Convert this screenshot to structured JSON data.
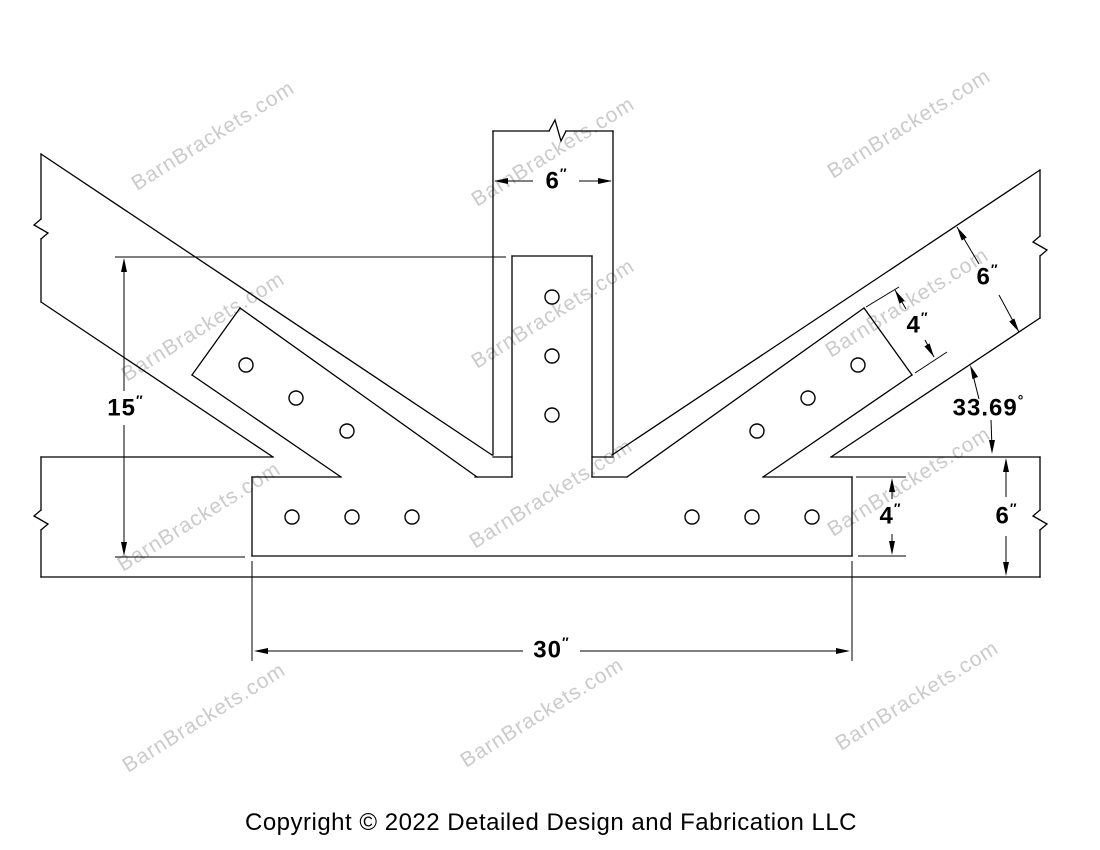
{
  "watermark": {
    "text": "BarnBrackets.com",
    "color": "#cbcbcb",
    "angle": -32,
    "positions": [
      [
        137,
        191
      ],
      [
        477,
        207
      ],
      [
        833,
        179
      ],
      [
        127,
        382
      ],
      [
        477,
        369
      ],
      [
        831,
        358
      ],
      [
        123,
        572
      ],
      [
        475,
        549
      ],
      [
        833,
        537
      ],
      [
        128,
        773
      ],
      [
        466,
        768
      ],
      [
        841,
        751
      ]
    ]
  },
  "copyright": {
    "text": "Copyright © 2022 Detailed Design and Fabrication LLC"
  },
  "drawing": {
    "line_color": "#000000",
    "timber_lines": [
      [
        493,
        131,
        549,
        131
      ],
      [
        566,
        131,
        613,
        131
      ],
      [
        493,
        131,
        493,
        455
      ],
      [
        613,
        131,
        613,
        455
      ],
      [
        41,
        457,
        273,
        457
      ],
      [
        493,
        457,
        512,
        457
      ],
      [
        592,
        457,
        613,
        457
      ],
      [
        831,
        457,
        1040,
        457
      ],
      [
        41,
        577,
        1040,
        577
      ],
      [
        41,
        457,
        41,
        510
      ],
      [
        41,
        530,
        41,
        577
      ],
      [
        1040,
        457,
        1040,
        510
      ],
      [
        1040,
        530,
        1040,
        577
      ],
      [
        41,
        154,
        492,
        455
      ],
      [
        41,
        302,
        273,
        457
      ],
      [
        41,
        154,
        41,
        219
      ],
      [
        41,
        239,
        41,
        302
      ],
      [
        612,
        455,
        1040,
        170
      ],
      [
        831,
        457,
        1040,
        318
      ],
      [
        1040,
        170,
        1040,
        236
      ],
      [
        1040,
        256,
        1040,
        318
      ]
    ],
    "break_symbols": [
      "549,131 555,120 561,141 566,131",
      "41,219 34,225 48,233 41,239",
      "41,510 34,516 48,524 41,530",
      "1040,236 1033,242 1047,250 1040,256",
      "1040,510 1033,516 1047,524 1040,530"
    ],
    "bracket_lines": [
      [
        512,
        256,
        592,
        256
      ],
      [
        512,
        256,
        512,
        477
      ],
      [
        592,
        256,
        592,
        477
      ],
      [
        252,
        477,
        341,
        477
      ],
      [
        475,
        477,
        512,
        477
      ],
      [
        592,
        477,
        627,
        477
      ],
      [
        763,
        477,
        852,
        477
      ],
      [
        252,
        556,
        852,
        556
      ],
      [
        252,
        477,
        252,
        556
      ],
      [
        852,
        477,
        852,
        556
      ],
      [
        240,
        308,
        477,
        477
      ],
      [
        192,
        375,
        341,
        477
      ],
      [
        240,
        308,
        192,
        375
      ],
      [
        864,
        308,
        627,
        477
      ],
      [
        912,
        375,
        763,
        477
      ],
      [
        864,
        308,
        912,
        375
      ]
    ],
    "hole_radius": 7,
    "holes": [
      [
        552,
        297
      ],
      [
        552,
        356
      ],
      [
        552,
        415
      ],
      [
        246,
        365
      ],
      [
        296,
        398
      ],
      [
        347,
        431
      ],
      [
        858,
        365
      ],
      [
        808,
        398
      ],
      [
        757,
        431
      ],
      [
        292,
        517
      ],
      [
        352,
        517
      ],
      [
        412,
        517
      ],
      [
        692,
        517
      ],
      [
        752,
        517
      ],
      [
        812,
        517
      ]
    ],
    "extension_lines": [
      [
        115,
        257,
        506,
        257
      ],
      [
        115,
        557,
        245,
        557
      ],
      [
        252,
        561,
        252,
        661
      ],
      [
        852,
        561,
        852,
        661
      ],
      [
        856,
        477,
        906,
        477
      ],
      [
        858,
        556,
        906,
        556
      ],
      [
        866,
        307,
        899,
        287
      ],
      [
        915,
        373,
        947,
        352
      ]
    ],
    "dimension_segments": [
      [
        495,
        181,
        533,
        181
      ],
      [
        579,
        181,
        611,
        181
      ],
      [
        124,
        260,
        124,
        391
      ],
      [
        124,
        425,
        124,
        554
      ],
      [
        256,
        651,
        523,
        651
      ],
      [
        580,
        651,
        848,
        651
      ],
      [
        892,
        480,
        892,
        499
      ],
      [
        892,
        534,
        892,
        553
      ],
      [
        1006,
        460,
        1006,
        497
      ],
      [
        1006,
        536,
        1006,
        574
      ],
      [
        957,
        227,
        979,
        264
      ],
      [
        999,
        295,
        1019,
        332
      ],
      [
        895,
        290,
        906,
        309
      ],
      [
        925,
        340,
        934,
        357
      ]
    ],
    "leader_lines": [
      [
        979,
        399,
        972,
        371
      ],
      [
        991,
        420,
        992,
        448
      ]
    ],
    "arrows": [
      [
        494,
        181,
        180
      ],
      [
        612,
        181,
        0
      ],
      [
        124,
        258,
        -90
      ],
      [
        124,
        556,
        90
      ],
      [
        254,
        651,
        180
      ],
      [
        850,
        651,
        0
      ],
      [
        892,
        478,
        -90
      ],
      [
        892,
        555,
        90
      ],
      [
        1006,
        458,
        -90
      ],
      [
        1006,
        576,
        90
      ],
      [
        957,
        227,
        -121
      ],
      [
        1019,
        332,
        59
      ],
      [
        895,
        290,
        -120
      ],
      [
        934,
        357,
        60
      ],
      [
        970,
        365,
        -112
      ],
      [
        992,
        454,
        90
      ]
    ],
    "labels": [
      {
        "name": "dim-post-width",
        "value": "6",
        "mark": "″",
        "x": 556,
        "y": 181
      },
      {
        "name": "dim-bracket-height",
        "value": "15",
        "mark": "″",
        "x": 125,
        "y": 408
      },
      {
        "name": "dim-bottom-plate-width",
        "value": "30",
        "mark": "″",
        "x": 551,
        "y": 650
      },
      {
        "name": "dim-bottom-plate-height",
        "value": "4",
        "mark": "″",
        "x": 890,
        "y": 516
      },
      {
        "name": "dim-beam-depth",
        "value": "6",
        "mark": "″",
        "x": 1006,
        "y": 516
      },
      {
        "name": "dim-brace-depth",
        "value": "6",
        "mark": "″",
        "x": 987,
        "y": 277
      },
      {
        "name": "dim-arm-width",
        "value": "4",
        "mark": "″",
        "x": 917,
        "y": 325
      },
      {
        "name": "dim-brace-angle",
        "value": "33.69",
        "mark": "°",
        "x": 988,
        "y": 408
      }
    ]
  }
}
